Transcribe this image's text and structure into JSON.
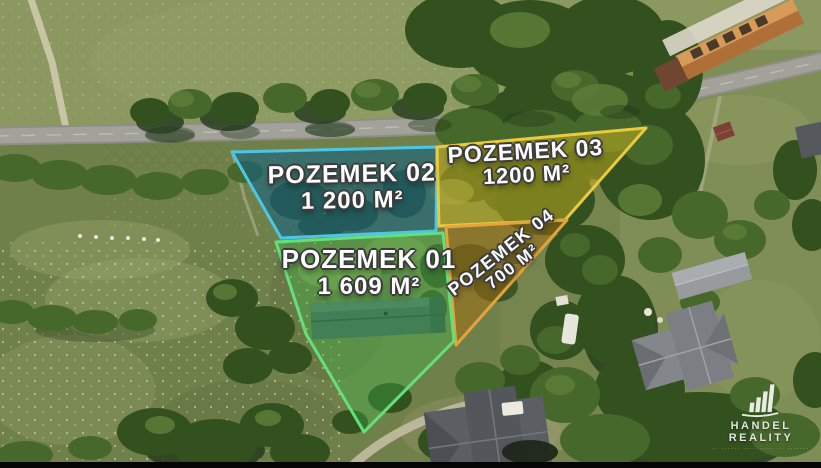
{
  "parcels": [
    {
      "id": "pozemek-01",
      "label": "POZEMEK 01",
      "area": "1 609 M²",
      "border_color": "#64df7c",
      "fill_color": "#3ebe4c"
    },
    {
      "id": "pozemek-02",
      "label": "POZEMEK 02",
      "area": "1 200 M²",
      "border_color": "#4cc6e6",
      "fill_color": "#0e5f87"
    },
    {
      "id": "pozemek-03",
      "label": "POZEMEK 03",
      "area": "1200 M²",
      "border_color": "#eaca3f",
      "fill_color": "#c8af1e"
    },
    {
      "id": "pozemek-04",
      "label": "POZEMEK 04",
      "area": "700 M²",
      "border_color": "#e6a33a",
      "fill_color": "#a56b12"
    }
  ],
  "watermark": {
    "brand": "HANDEL REALITY",
    "tagline": "·· ······ ·········· ·· ·······"
  }
}
